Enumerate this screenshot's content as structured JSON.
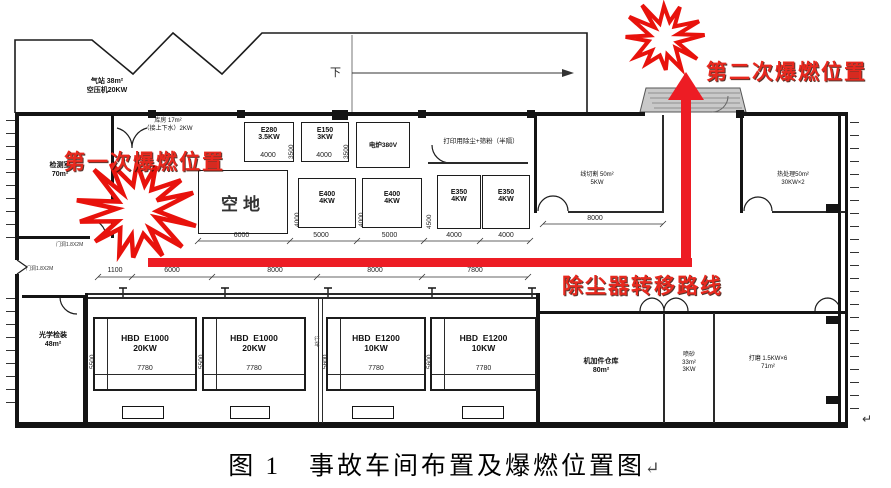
{
  "caption": {
    "text": "图 1　事故车间布置及爆燃位置图",
    "mark": "↵"
  },
  "annotations": {
    "first_explosion": "第一次爆燃位置",
    "second_explosion": "第二次爆燃位置",
    "route": "除尘器转移路线",
    "down": "下",
    "crane": "行车",
    "para_mark": "↵",
    "door_note1": "门洞1.8X2M",
    "door_note2": "门洞1.8X2M"
  },
  "colors": {
    "red": "#e8281e",
    "wall": "#141414",
    "canopy": "#c9c9c9"
  },
  "rooms": {
    "gas_station": {
      "line1": "气站 38m²",
      "line2": "空压机20KW"
    },
    "storage": {
      "line1": "库房 17m²",
      "line2": "（接上下水）2KW"
    },
    "inspection": {
      "line1": "检测室",
      "line2": "70m²"
    },
    "empty_lot": {
      "label": "空地"
    },
    "print_dust": {
      "label": "打印用除尘+筛粉（半隔）"
    },
    "wire_cutting": {
      "line1": "线切割 50m²",
      "line2": "5KW",
      "dim": "8000"
    },
    "heat_treatment": {
      "line1": "热处理50m²",
      "line2": "30KW×2"
    },
    "optical": {
      "line1": "光学检装",
      "line2": "48m²"
    },
    "warehouse": {
      "line1": "机加件仓库",
      "line2": "80m²"
    },
    "sandblasting": {
      "line1": "喷砂",
      "line2": "33m²",
      "line3": "3KW"
    },
    "grinding": {
      "line1": "打磨 1.5KW×6",
      "line2": "71m²"
    }
  },
  "machines": {
    "e280": {
      "model": "E280",
      "power": "3.5KW",
      "w": "4000",
      "h": "3500"
    },
    "e150": {
      "model": "E150",
      "power": "3KW",
      "w": "4000",
      "h": "3500"
    },
    "furnace": {
      "model": "电炉380V"
    },
    "e400a": {
      "model": "E400",
      "power": "4KW",
      "w": "5000",
      "h": "4000"
    },
    "e400b": {
      "model": "E400",
      "power": "4KW",
      "w": "5000",
      "h": "4000"
    },
    "e350a": {
      "model": "E350",
      "power": "4KW",
      "w": "4000",
      "h": "4500"
    },
    "e350b": {
      "model": "E350",
      "power": "4KW",
      "w": "4000"
    },
    "hbd1": {
      "model": "HBD  E1000",
      "power": "20KW",
      "w": "7780",
      "h": "5500"
    },
    "hbd2": {
      "model": "HBD  E1000",
      "power": "20KW",
      "w": "7780",
      "h": "5500"
    },
    "hbd3": {
      "model": "HBD  E1200",
      "power": "10KW",
      "w": "7780",
      "h": "5600"
    },
    "hbd4": {
      "model": "HBD  E1200",
      "power": "10KW",
      "w": "7780",
      "h": "5600"
    }
  },
  "dims": {
    "empty_lot": "6000",
    "row_route": [
      "1100",
      "6000",
      "8000",
      "8000",
      "7800"
    ]
  }
}
